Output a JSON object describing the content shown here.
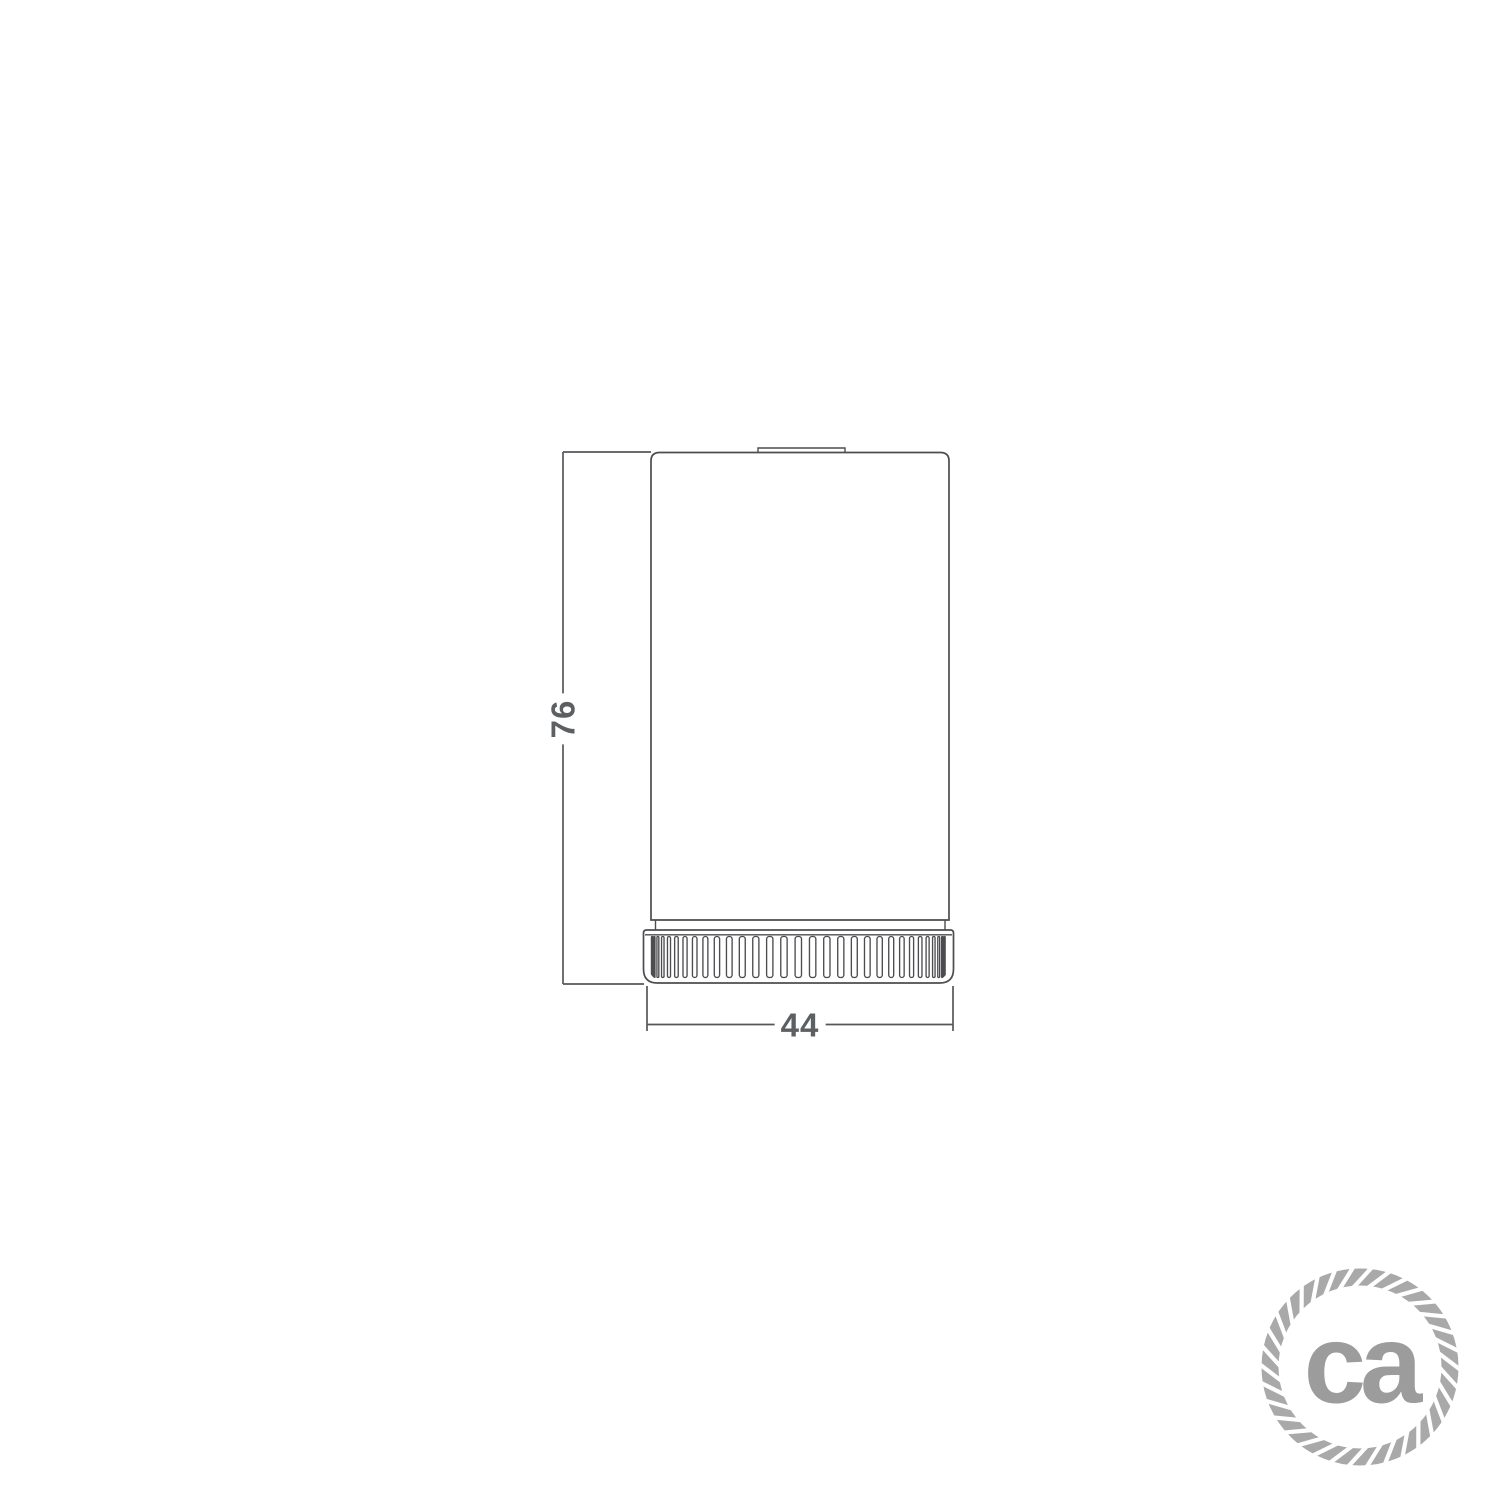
{
  "canvas": {
    "background": "#ffffff"
  },
  "drawing": {
    "object_name": "cylindrical-lampholder-side-view",
    "stroke_color": "#4d4d50",
    "dimension_line_color": "#55585b",
    "dimension_text_color": "#5c6063",
    "height_label": "76",
    "width_label": "44"
  },
  "logo": {
    "text": "ca",
    "text_color": "#9c9c9c",
    "rope_color": "#a9a9a9"
  }
}
